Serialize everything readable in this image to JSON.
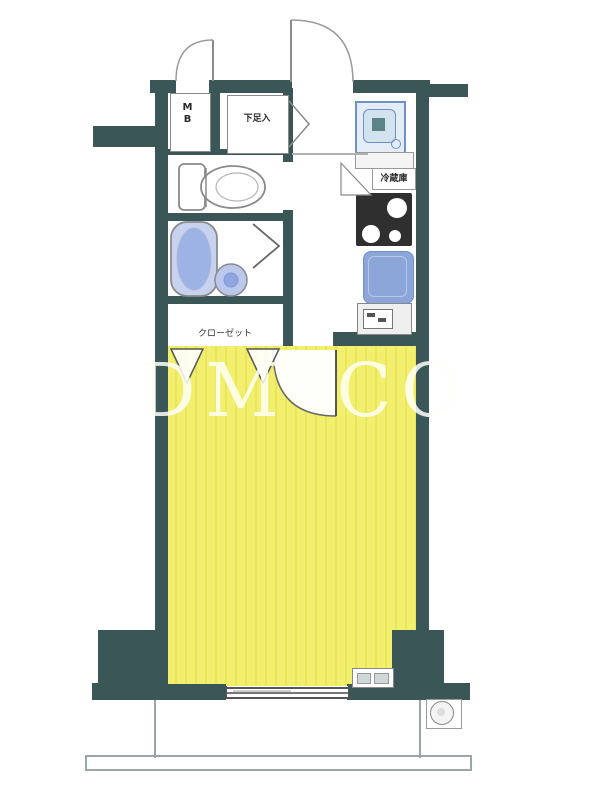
{
  "plan": {
    "type": "japanese-apartment-floor-plan",
    "labels": {
      "meter_box": "MB",
      "shoe_cabinet": "下足入",
      "refrigerator": "冷蔵庫",
      "closet": "クローゼット",
      "watermark": "DM CO"
    },
    "colors": {
      "wall": "#3b5656",
      "room_floor": "#f2ef6f",
      "room_floor_stripe": "#eae659",
      "bathtub": "#c6d2ee",
      "bathtub_inner": "#9db3e6",
      "washbasin": "#b9c8ec",
      "kitchen_sink": "#8ca6da",
      "washer_frame": "#7090c8",
      "stove": "#2f2f2f",
      "line": "#8a8a8a",
      "watermark_color": "rgba(255,255,248,0.85)"
    }
  }
}
